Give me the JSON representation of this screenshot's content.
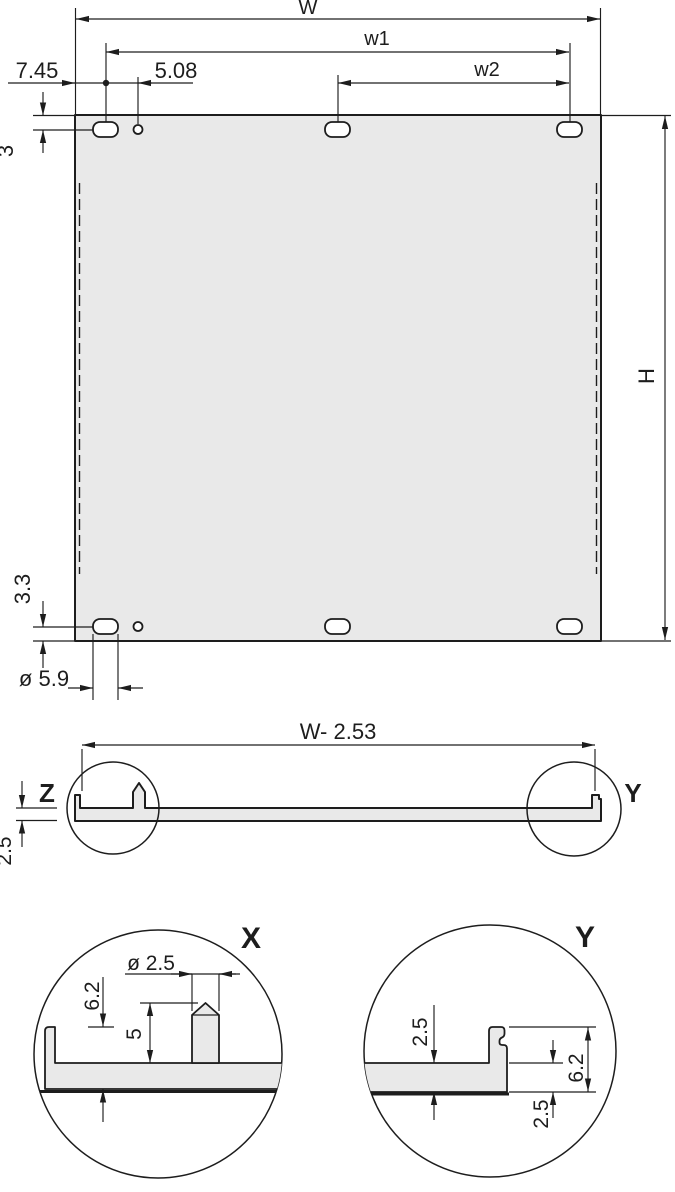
{
  "colors": {
    "line": "#1d1d1d",
    "panel_fill": "#e9e9e9",
    "hole_fill": "#ffffff",
    "background": "#ffffff"
  },
  "front_view": {
    "width_label": "W",
    "w1_label": "w1",
    "w2_label": "w2",
    "left_edge_offset": "7.45",
    "hole_offset": "5.08",
    "top_slot_offset": "3",
    "height_label": "H",
    "bottom_slot_offset": "3.3",
    "slot_diameter": "ø 5.9"
  },
  "section_view": {
    "width_label": "W- 2.53",
    "detail_z_label": "Z",
    "detail_y_label": "Y",
    "thickness": "2.5"
  },
  "detail_x": {
    "label": "X",
    "pin_diameter": "ø 2.5",
    "edge_height": "6.2",
    "pin_height": "5"
  },
  "detail_y": {
    "label": "Y",
    "thickness_top": "2.5",
    "edge_height": "6.2",
    "thickness_bottom": "2.5"
  }
}
